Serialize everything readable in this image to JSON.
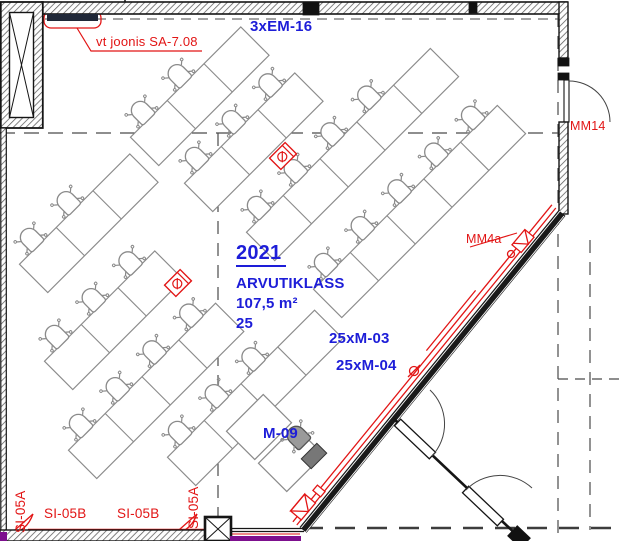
{
  "drawing": {
    "room": {
      "number": "2021",
      "name": "ARVUTIKLASS",
      "area": "107,5 m²",
      "capacity": "25"
    },
    "annotations": [
      {
        "id": "ref-note",
        "text": "vt joonis SA-7.08",
        "x": 96,
        "y": 35,
        "color": "red",
        "size": 13
      },
      {
        "id": "em16-label",
        "text": "3xEM-16",
        "x": 250,
        "y": 19,
        "color": "blue",
        "size": 15
      },
      {
        "id": "room-number",
        "text": "2021",
        "x": 236,
        "y": 243,
        "color": "blue",
        "size": 20,
        "bold": true,
        "underline": true
      },
      {
        "id": "room-name",
        "text": "ARVUTIKLASS",
        "x": 236,
        "y": 276,
        "color": "blue",
        "size": 15
      },
      {
        "id": "room-area",
        "text": "107,5 m²",
        "x": 236,
        "y": 296,
        "color": "blue",
        "size": 15
      },
      {
        "id": "room-capacity",
        "text": "25",
        "x": 236,
        "y": 316,
        "color": "blue",
        "size": 15
      },
      {
        "id": "m03-label",
        "text": "25xM-03",
        "x": 329,
        "y": 331,
        "color": "blue",
        "size": 15
      },
      {
        "id": "m04-label",
        "text": "25xM-04",
        "x": 336,
        "y": 358,
        "color": "blue",
        "size": 15
      },
      {
        "id": "m09-label",
        "text": "M-09",
        "x": 263,
        "y": 426,
        "color": "blue",
        "size": 15
      },
      {
        "id": "mm4a-label",
        "text": "MM4a",
        "x": 466,
        "y": 233,
        "color": "red",
        "size": 12.5
      },
      {
        "id": "mm14-label",
        "text": "MM14",
        "x": 570,
        "y": 120,
        "color": "red",
        "size": 12.5
      },
      {
        "id": "si05b-label-1",
        "text": "SI-05B",
        "x": 44,
        "y": 507,
        "color": "red",
        "size": 13.5
      },
      {
        "id": "si05b-label-2",
        "text": "SI-05B",
        "x": 117,
        "y": 507,
        "color": "red",
        "size": 13.5
      },
      {
        "id": "si05a-label-1",
        "text": "SI-05A",
        "x": 14,
        "y": 533,
        "color": "red",
        "size": 13.5,
        "rotate": -90
      },
      {
        "id": "si05a-label-2",
        "text": "SI-05A",
        "x": 187,
        "y": 529,
        "color": "red",
        "size": 13.5,
        "rotate": -90
      }
    ],
    "colors": {
      "annotation_blue": "#1d1dd8",
      "annotation_red": "#e21515",
      "desk_gray": "#8a8a8a",
      "wall_black": "#1a1a1a",
      "grid_gray": "#4a4a4a",
      "services_purple": "#7d0f8e"
    },
    "furniture": {
      "desk_pitch": 52,
      "desk_depth": 40,
      "rows": [
        {
          "name": "row-a",
          "x": 52,
          "y": 260,
          "desks": 3,
          "chairs": [
            1,
            1,
            0
          ]
        },
        {
          "name": "row-b",
          "x": 77,
          "y": 357,
          "desks": 3,
          "chairs": [
            1,
            1,
            1
          ]
        },
        {
          "name": "row-c",
          "x": 101,
          "y": 446,
          "desks": 4,
          "chairs": [
            1,
            1,
            1,
            1
          ]
        },
        {
          "name": "row-d",
          "x": 200,
          "y": 453,
          "desks": 4,
          "chairs": [
            1,
            1,
            1,
            0
          ]
        },
        {
          "name": "row-t1",
          "x": 163,
          "y": 133,
          "desks": 3,
          "chairs": [
            1,
            1,
            0
          ]
        },
        {
          "name": "row-t2",
          "x": 217,
          "y": 179,
          "desks": 3,
          "chairs": [
            1,
            1,
            1
          ]
        },
        {
          "name": "row-t3",
          "x": 279,
          "y": 228,
          "desks": 5,
          "chairs": [
            1,
            1,
            1,
            1,
            0
          ]
        },
        {
          "name": "row-t4",
          "x": 346,
          "y": 285,
          "desks": 5,
          "chairs": [
            1,
            1,
            1,
            1,
            1
          ]
        }
      ],
      "teacher_station": {
        "desks": [
          {
            "x": 259,
            "y": 427
          },
          {
            "x": 291,
            "y": 459
          }
        ],
        "chair": {
          "x": 297,
          "y": 436
        },
        "printer": {
          "x": 314,
          "y": 456
        }
      },
      "floor_boxes": [
        {
          "x": 178,
          "y": 283
        },
        {
          "x": 283,
          "y": 156
        }
      ]
    }
  }
}
